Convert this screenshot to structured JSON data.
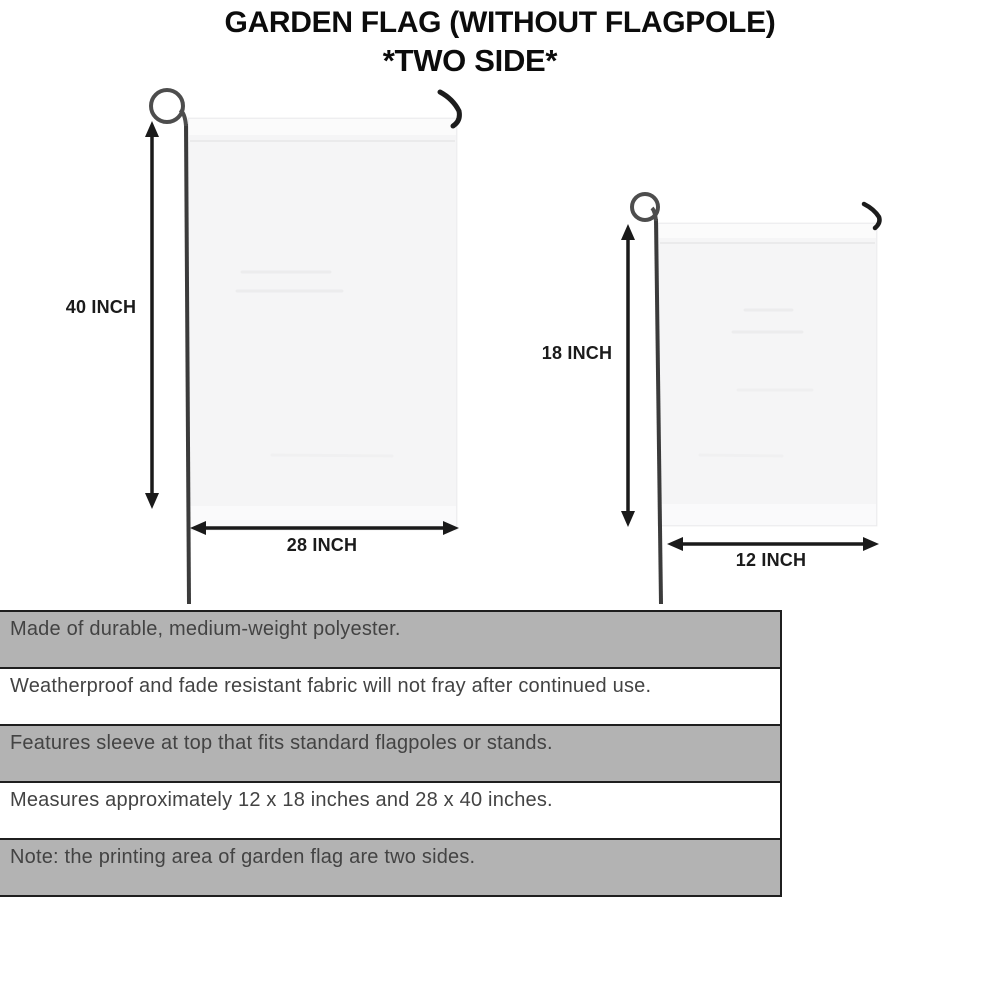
{
  "title": {
    "line1": "GARDEN FLAG (WITHOUT FLAGPOLE)",
    "line2": "*TWO SIDE*"
  },
  "diagram": {
    "large_flag": {
      "name": "large garden flag 28 x 40 inches",
      "height_label": "40 INCH",
      "width_label": "28 INCH"
    },
    "small_flag": {
      "name": "small garden flag 12 x 18 inches",
      "height_label": "18 INCH",
      "width_label": "12 INCH"
    }
  },
  "features": [
    "Made of durable, medium-weight polyester.",
    "Weatherproof and fade resistant fabric will not fray after continued use.",
    "Features sleeve at top that fits standard flagpoles or stands.",
    "Measures approximately 12 x 18 inches and 28 x 40 inches.",
    "Note: the printing area of garden flag are two sides."
  ],
  "colors": {
    "row_shaded": "#b3b3b3",
    "row_plain": "#ffffff",
    "flag_fill": "#f5f5f6",
    "pole": "#3b3b3b",
    "arrow": "#1a1a1a",
    "title_text": "#0c0c0c",
    "feature_text": "#434343"
  }
}
